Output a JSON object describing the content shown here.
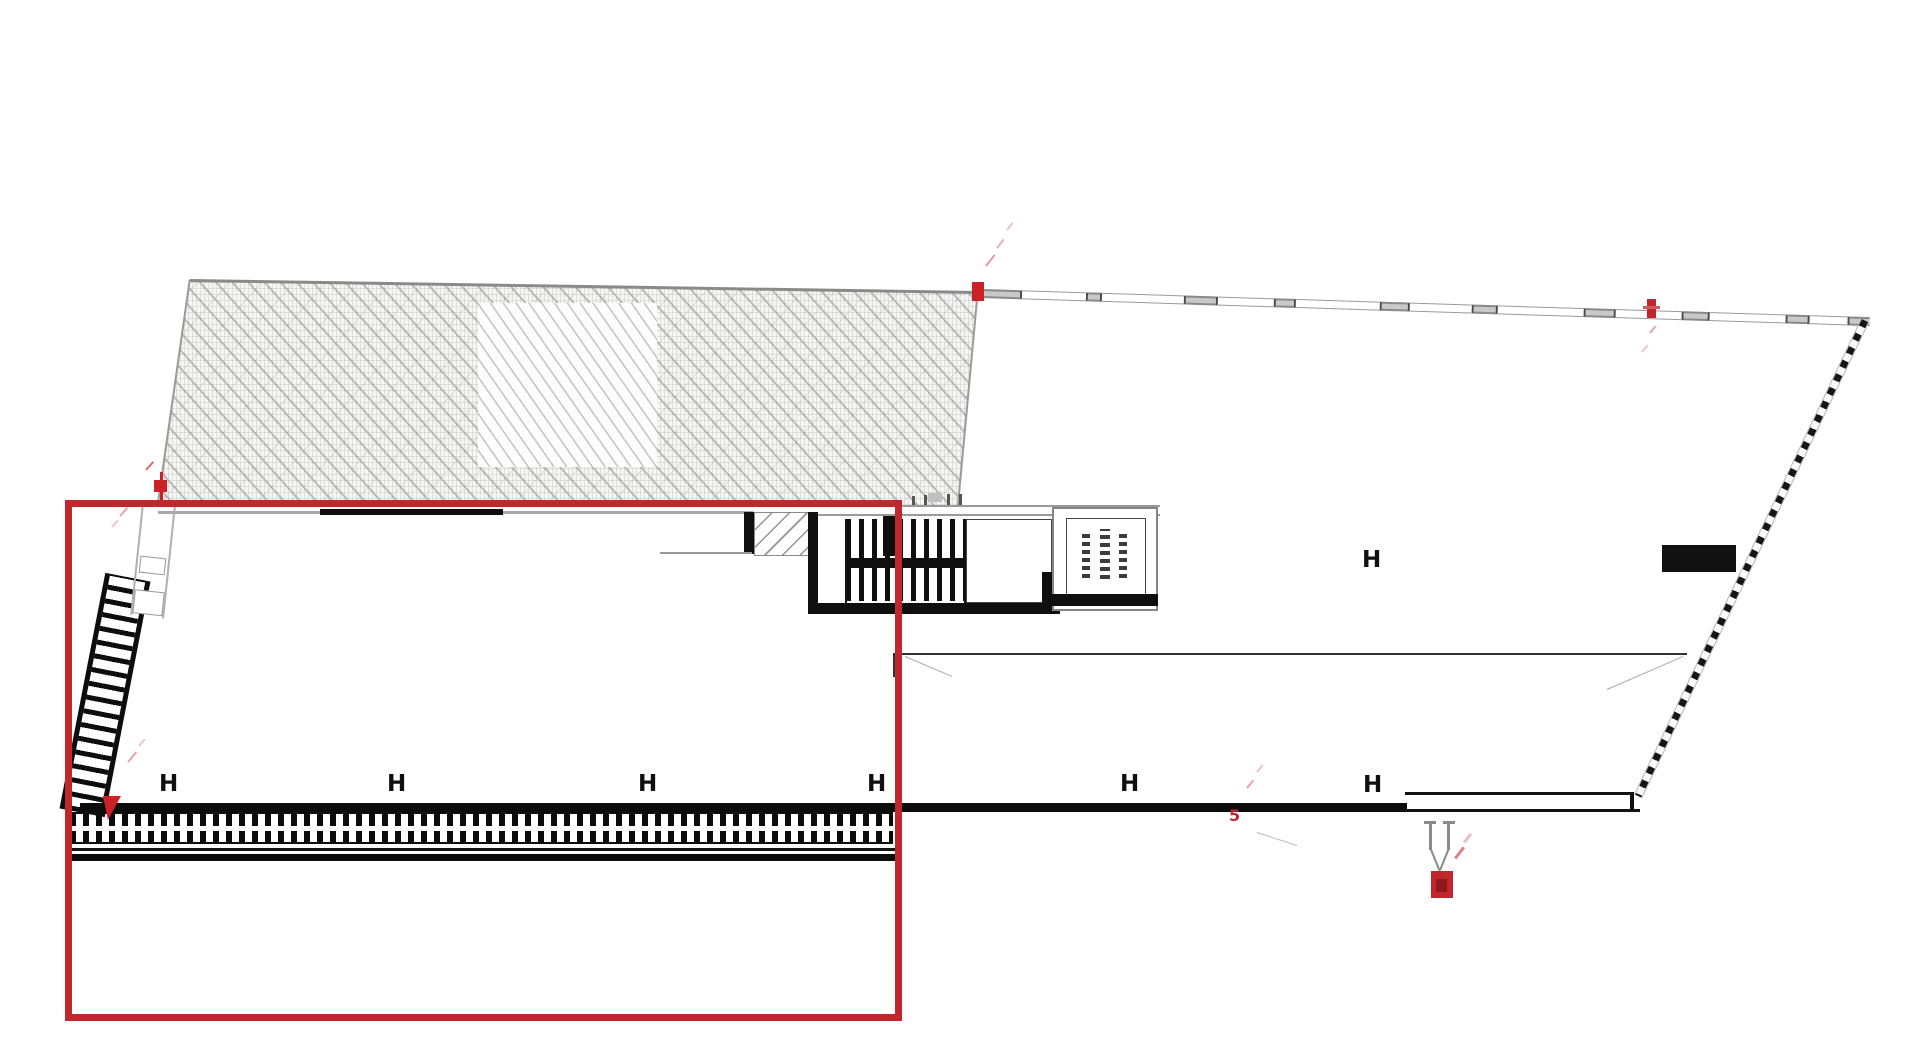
{
  "meta": {
    "kind": "architectural-site-plan",
    "width": 1920,
    "height": 1063,
    "background": "#ffffff"
  },
  "colors": {
    "selection_red": "#c3272e",
    "marker_red": "#cb2127",
    "marker_red_dark": "#8f181d",
    "pink_faint": "#e8a3a6",
    "wall_black": "#0d0d0d",
    "line_gray": "#9a9a9a",
    "wall_light_gray": "#c9c9c9"
  },
  "h_markers": {
    "glyph": "H",
    "positions": [
      [
        170,
        785
      ],
      [
        398,
        785
      ],
      [
        649,
        785
      ],
      [
        878,
        785
      ],
      [
        1131,
        785
      ],
      [
        1374,
        786
      ],
      [
        1373,
        561
      ]
    ]
  },
  "labels": {
    "five": "5"
  },
  "layers": [
    {
      "type": "poly",
      "name": "excavation-hatch-region",
      "cls": "hatch-texture",
      "points": [
        [
          190,
          280
        ],
        [
          978,
          292
        ],
        [
          958,
          507
        ],
        [
          158,
          504
        ]
      ]
    },
    {
      "type": "rect",
      "name": "hatch-light-patch",
      "cls": "light-patch",
      "x": 478,
      "y": 303,
      "w": 179,
      "h": 164
    },
    {
      "type": "line",
      "name": "hatch-top-edge",
      "x": 190,
      "y": 280,
      "len": 788,
      "thick": 2.5,
      "color": "#8a8a8a",
      "angle": 0.87
    },
    {
      "type": "line",
      "name": "hatch-left-edge",
      "x": 190,
      "y": 280,
      "len": 226,
      "thick": 1.5,
      "color": "#9a9a9a",
      "angle": 98.1
    },
    {
      "type": "line",
      "name": "hatch-right-edge",
      "x": 978,
      "y": 292,
      "len": 216,
      "thick": 1.5,
      "color": "#9a9a9a",
      "angle": 95.3
    },
    {
      "type": "rect",
      "name": "top-wall-gray-segment",
      "x": 158,
      "y": 511,
      "w": 162,
      "h": 3,
      "fill": "#a8a8a8"
    },
    {
      "type": "rect",
      "name": "top-wall-black-segment",
      "x": 320,
      "y": 509,
      "w": 183,
      "h": 6,
      "fill": "#0d0d0d"
    },
    {
      "type": "rect",
      "name": "top-wall-gray-segment",
      "x": 503,
      "y": 511,
      "w": 250,
      "h": 3,
      "fill": "#a8a8a8"
    },
    {
      "type": "rect",
      "name": "stair-entry-stub-wall",
      "x": 744,
      "y": 512,
      "w": 10,
      "h": 42,
      "fill": "#0f0f0f"
    },
    {
      "type": "rect",
      "name": "stair-entry-box",
      "cls": "entry-box",
      "x": 754,
      "y": 512,
      "w": 58,
      "h": 44
    },
    {
      "type": "rect",
      "name": "stair-top-line",
      "x": 812,
      "y": 505,
      "w": 348,
      "h": 2,
      "fill": "#9a9a9a"
    },
    {
      "type": "rect",
      "name": "stair-top-line",
      "x": 812,
      "y": 514,
      "w": 348,
      "h": 2,
      "fill": "#9a9a9a"
    },
    {
      "type": "rect",
      "name": "stair-left-wall",
      "x": 808,
      "y": 512,
      "w": 10,
      "h": 100,
      "fill": "#0f0f0f"
    },
    {
      "type": "rect",
      "name": "stair-bottom-wall",
      "x": 808,
      "y": 603,
      "w": 252,
      "h": 11,
      "fill": "#0f0f0f"
    },
    {
      "type": "treads",
      "name": "stair-treads",
      "x": 846,
      "y": 519,
      "w": 120,
      "h": 82,
      "bar": 5,
      "gap": 8,
      "color": "#0f0f0f"
    },
    {
      "type": "rect",
      "name": "stair-mid-landing-bar",
      "x": 846,
      "y": 558,
      "w": 120,
      "h": 10,
      "fill": "#0f0f0f"
    },
    {
      "type": "rect",
      "name": "stair-side-rail",
      "x": 845,
      "y": 519,
      "w": 2,
      "h": 84,
      "fill": "#111111"
    },
    {
      "type": "rect",
      "name": "stair-side-rail",
      "x": 964,
      "y": 519,
      "w": 2,
      "h": 84,
      "fill": "#111111"
    },
    {
      "type": "rect",
      "name": "stair-wall-chunk",
      "x": 883,
      "y": 516,
      "w": 18,
      "h": 40,
      "fill": "#0d0d0d"
    },
    {
      "type": "rect",
      "name": "stair-landing-box",
      "cls": "thin-box",
      "x": 966,
      "y": 519,
      "w": 86,
      "h": 84
    },
    {
      "type": "rect",
      "name": "landing-right-wall",
      "x": 1042,
      "y": 572,
      "w": 10,
      "h": 31,
      "fill": "#0f0f0f"
    },
    {
      "type": "rect",
      "name": "guard-tick",
      "x": 912,
      "y": 496,
      "w": 3,
      "h": 9,
      "fill": "#555555"
    },
    {
      "type": "rect",
      "name": "guard-tick",
      "x": 924,
      "y": 495,
      "w": 3,
      "h": 10,
      "fill": "#555555"
    },
    {
      "type": "rect",
      "name": "guard-tick",
      "x": 947,
      "y": 494,
      "w": 3,
      "h": 11,
      "fill": "#555555"
    },
    {
      "type": "rect",
      "name": "guard-tick",
      "x": 959,
      "y": 494,
      "w": 3,
      "h": 11,
      "fill": "#555555"
    },
    {
      "type": "rect",
      "name": "guard-chunk",
      "x": 928,
      "y": 493,
      "w": 14,
      "h": 9,
      "fill": "#c0c0c0"
    },
    {
      "type": "rect",
      "name": "elevator-outer-box",
      "cls": "thin-box-gray",
      "x": 1052,
      "y": 507,
      "w": 106,
      "h": 104
    },
    {
      "type": "rect",
      "name": "elevator-inner-box",
      "cls": "thin-box",
      "x": 1066,
      "y": 518,
      "w": 80,
      "h": 80
    },
    {
      "type": "rect",
      "name": "elevator-label-illegible",
      "cls": "glyph-dashes",
      "x": 1082,
      "y": 534,
      "w": 8,
      "h": 44
    },
    {
      "type": "rect",
      "name": "elevator-label-illegible",
      "cls": "glyph-dashes",
      "x": 1100,
      "y": 529,
      "w": 10,
      "h": 50
    },
    {
      "type": "rect",
      "name": "elevator-label-illegible",
      "cls": "glyph-dashes",
      "x": 1119,
      "y": 532,
      "w": 8,
      "h": 46
    },
    {
      "type": "rect",
      "name": "elevator-bottom-wall",
      "x": 1050,
      "y": 594,
      "w": 108,
      "h": 12,
      "fill": "#0f0f0f"
    },
    {
      "type": "rect",
      "name": "interior-wall-line",
      "x": 660,
      "y": 552,
      "w": 92,
      "h": 2,
      "fill": "#999999"
    },
    {
      "type": "rect",
      "name": "floor-edge-line",
      "x": 893,
      "y": 653,
      "w": 794,
      "h": 2,
      "fill": "#333333"
    },
    {
      "type": "rect",
      "name": "floor-edge-tick",
      "x": 893,
      "y": 653,
      "w": 2,
      "h": 24,
      "fill": "#333333"
    },
    {
      "type": "line",
      "name": "leader-line",
      "x": 905,
      "y": 657,
      "len": 51,
      "thick": 1.2,
      "color": "#ababab",
      "angle": 23
    },
    {
      "type": "line",
      "name": "leader-line",
      "x": 1607,
      "y": 690,
      "len": 83,
      "thick": 1.2,
      "color": "#ababab",
      "angle": -23.5
    },
    {
      "type": "line",
      "name": "leader-line",
      "x": 1257,
      "y": 833,
      "len": 42,
      "thick": 1.2,
      "color": "#bbbbbb",
      "angle": 18
    },
    {
      "type": "rect",
      "name": "retaining-wall-top-line",
      "x": 80,
      "y": 803,
      "w": 1327,
      "h": 9,
      "fill": "#0c0c0c"
    },
    {
      "type": "rungs",
      "name": "retaining-wall-crosshatch",
      "x": 70,
      "y": 812,
      "w": 823,
      "h": 32,
      "bar": 6,
      "gap": 7,
      "color": "#0c0c0c"
    },
    {
      "type": "rect",
      "name": "crosshatch-gap",
      "x": 70,
      "y": 826,
      "w": 823,
      "h": 5,
      "fill": "#ffffff"
    },
    {
      "type": "rect",
      "name": "crosshatch-edge",
      "x": 70,
      "y": 812,
      "w": 823,
      "h": 2,
      "fill": "#0c0c0c"
    },
    {
      "type": "rect",
      "name": "crosshatch-edge",
      "x": 70,
      "y": 842,
      "w": 823,
      "h": 2,
      "fill": "#0c0c0c"
    },
    {
      "type": "rect",
      "name": "lower-wall-line-thin",
      "x": 65,
      "y": 848,
      "w": 830,
      "h": 2.5,
      "fill": "#151515"
    },
    {
      "type": "rect",
      "name": "lower-wall-line-thick",
      "x": 65,
      "y": 854,
      "w": 830,
      "h": 7,
      "fill": "#0c0c0c"
    },
    {
      "type": "rect",
      "name": "right-wall-outline-top",
      "x": 1405,
      "y": 792,
      "w": 228,
      "h": 3,
      "fill": "#111111"
    },
    {
      "type": "rect",
      "name": "right-wall-outline-bottom",
      "x": 1400,
      "y": 809,
      "w": 240,
      "h": 3,
      "fill": "#111111"
    },
    {
      "type": "rect",
      "name": "right-wall-outline-cap",
      "x": 1630,
      "y": 792,
      "w": 4,
      "h": 20,
      "fill": "#111111"
    },
    {
      "type": "ladder",
      "name": "stepped-retaining-wall",
      "cx": 105,
      "cy": 695,
      "w": 46,
      "h": 240,
      "rotate": 11,
      "rail": 5,
      "spacing": 14,
      "color": "#0d0d0d"
    },
    {
      "type": "leftwall",
      "name": "left-boundary-wall",
      "x": 136,
      "y": 505,
      "w": 34,
      "h": 112,
      "rotate": 6,
      "boxes": [
        [
          2,
          52,
          26,
          17
        ],
        [
          0,
          86,
          30,
          24
        ]
      ]
    },
    {
      "type": "windowwall",
      "name": "perimeter-window-wall",
      "x": 980,
      "y": 289,
      "angle": 1.81,
      "h": 9,
      "segments": [
        40,
        68,
        12,
        86,
        30,
        60,
        18,
        88,
        26,
        66,
        22,
        90,
        28,
        70,
        24,
        80,
        20,
        42,
        20
      ]
    },
    {
      "type": "line",
      "name": "site-boundary-checkered",
      "cls": "checker",
      "x": 1865,
      "y": 320,
      "len": 527,
      "thick": 9,
      "angle": 115.5
    },
    {
      "type": "rect",
      "name": "dark-wall-block",
      "x": 1662,
      "y": 545,
      "w": 74,
      "h": 27,
      "fill": "#111111"
    },
    {
      "type": "hmarkers",
      "name": "column-marker"
    },
    {
      "type": "rect",
      "name": "red-selection-rectangle",
      "cls": "red-outline",
      "x": 65,
      "y": 500,
      "w": 837,
      "h": 521
    },
    {
      "type": "rect",
      "name": "red-survey-marker-top",
      "x": 972,
      "y": 282,
      "w": 12,
      "h": 19,
      "fill": "#cb2127"
    },
    {
      "type": "line",
      "name": "red-dash",
      "x": 986,
      "y": 266,
      "len": 14,
      "thick": 2,
      "color": "#e29a9e",
      "angle": -52
    },
    {
      "type": "line",
      "name": "red-dash",
      "x": 997,
      "y": 248,
      "len": 11,
      "thick": 2,
      "color": "#e8b0b3",
      "angle": -52
    },
    {
      "type": "line",
      "name": "red-dash",
      "x": 1007,
      "y": 230,
      "len": 9,
      "thick": 2,
      "color": "#eec3c5",
      "angle": -52
    },
    {
      "type": "rect",
      "name": "red-survey-marker-topright",
      "x": 1647,
      "y": 299,
      "w": 9,
      "h": 19,
      "fill": "#c2262c"
    },
    {
      "type": "rect",
      "name": "red-survey-marker-arm",
      "x": 1643,
      "y": 306,
      "w": 17,
      "h": 3,
      "fill": "#cf5a5f"
    },
    {
      "type": "line",
      "name": "red-dash",
      "x": 1650,
      "y": 333,
      "len": 9,
      "thick": 2,
      "color": "#e8a3a6",
      "angle": -50
    },
    {
      "type": "line",
      "name": "red-dash",
      "x": 1642,
      "y": 352,
      "len": 9,
      "thick": 2,
      "color": "#eec3c5",
      "angle": -50
    },
    {
      "type": "rect",
      "name": "red-flag-pole",
      "x": 160,
      "y": 472,
      "w": 2.5,
      "h": 30,
      "fill": "#cb2127"
    },
    {
      "type": "rect",
      "name": "red-flag",
      "x": 154,
      "y": 480,
      "w": 13,
      "h": 12,
      "fill": "#cb2127"
    },
    {
      "type": "line",
      "name": "red-dash",
      "x": 146,
      "y": 470,
      "len": 11,
      "thick": 2,
      "color": "#d96a6f",
      "angle": -48
    },
    {
      "type": "line",
      "name": "red-dash",
      "x": 120,
      "y": 516,
      "len": 11,
      "thick": 2,
      "color": "#e8a3a6",
      "angle": -48
    },
    {
      "type": "line",
      "name": "red-dash",
      "x": 112,
      "y": 527,
      "len": 9,
      "thick": 2,
      "color": "#eec3c5",
      "angle": -48
    },
    {
      "type": "tri",
      "name": "red-arrow-marker",
      "x": 103,
      "y": 796,
      "bl": 5,
      "br": 13,
      "bh": 24,
      "fill": "#cb2127"
    },
    {
      "type": "line",
      "name": "red-dash",
      "x": 128,
      "y": 762,
      "len": 13,
      "thick": 2,
      "color": "#e8a3a6",
      "angle": -50
    },
    {
      "type": "line",
      "name": "red-dash",
      "x": 139,
      "y": 746,
      "len": 9,
      "thick": 2,
      "color": "#eec3c5",
      "angle": -50
    },
    {
      "type": "text",
      "name": "red-label-5",
      "bind": "labels.five",
      "x": 1229,
      "y": 808,
      "size": 16,
      "color": "#c2262c"
    },
    {
      "type": "line",
      "name": "red-dash",
      "x": 1247,
      "y": 788,
      "len": 10,
      "thick": 2,
      "color": "#e8a3a6",
      "angle": -50
    },
    {
      "type": "line",
      "name": "red-dash",
      "x": 1257,
      "y": 772,
      "len": 9,
      "thick": 2,
      "color": "#eec3c5",
      "angle": -50
    },
    {
      "type": "rect",
      "name": "fork-prong",
      "x": 1429,
      "y": 823,
      "w": 3,
      "h": 27,
      "fill": "#8a8a8a"
    },
    {
      "type": "rect",
      "name": "fork-prong",
      "x": 1447,
      "y": 823,
      "w": 3,
      "h": 27,
      "fill": "#8a8a8a"
    },
    {
      "type": "rect",
      "name": "fork-serif",
      "x": 1424,
      "y": 821,
      "w": 12,
      "h": 2.5,
      "fill": "#8a8a8a"
    },
    {
      "type": "rect",
      "name": "fork-serif",
      "x": 1443,
      "y": 821,
      "w": 12,
      "h": 2.5,
      "fill": "#8a8a8a"
    },
    {
      "type": "line",
      "name": "fork-stem",
      "x": 1431,
      "y": 849,
      "len": 24,
      "thick": 1.5,
      "color": "#8a8a8a",
      "angle": 68
    },
    {
      "type": "line",
      "name": "fork-stem",
      "x": 1449,
      "y": 849,
      "len": 23,
      "thick": 1.5,
      "color": "#8a8a8a",
      "angle": 112
    },
    {
      "type": "rect",
      "name": "red-survey-station",
      "x": 1431,
      "y": 871,
      "w": 22,
      "h": 27,
      "fill": "#c2262c"
    },
    {
      "type": "rect",
      "name": "red-survey-station-core",
      "x": 1436,
      "y": 879,
      "w": 11,
      "h": 13,
      "fill": "#8f181d"
    },
    {
      "type": "line",
      "name": "red-dash",
      "x": 1455,
      "y": 858,
      "len": 14,
      "thick": 2.5,
      "color": "#dc8287",
      "angle": -52
    },
    {
      "type": "line",
      "name": "red-dash",
      "x": 1464,
      "y": 842,
      "len": 11,
      "thick": 2.5,
      "color": "#eabfc1",
      "angle": -52
    }
  ]
}
